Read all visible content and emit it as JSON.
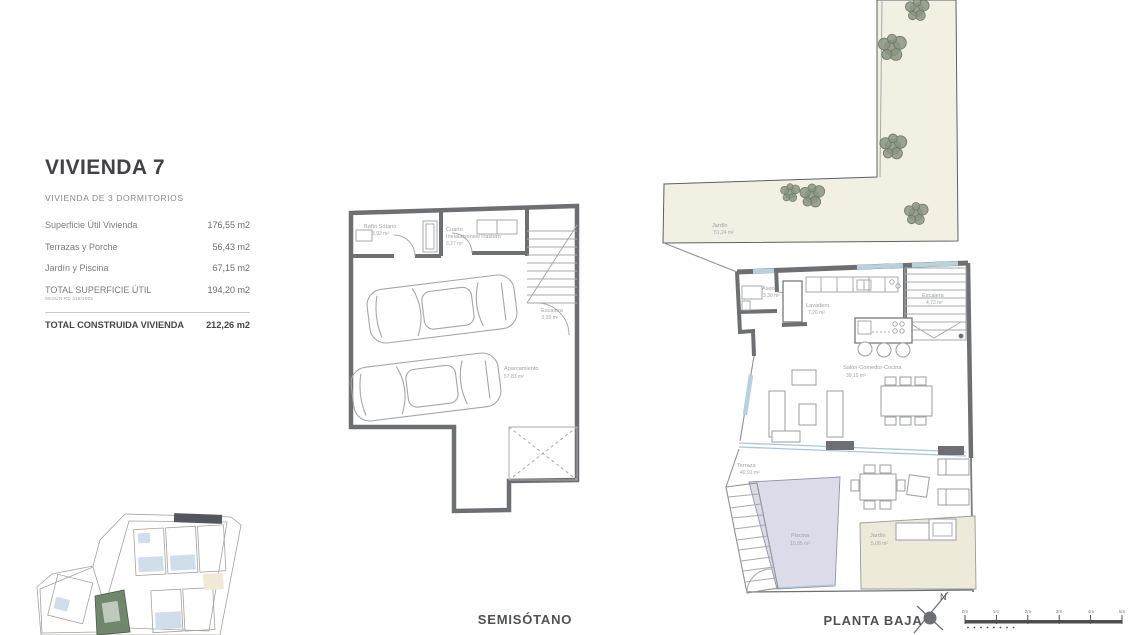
{
  "info": {
    "title": "VIVIENDA 7",
    "subtitle": "VIVIENDA DE 3 DORMITORIOS",
    "rows": [
      {
        "label": "Superficie Útil Vivienda",
        "value": "176,55 m2"
      },
      {
        "label": "Terrazas y Porche",
        "value": "56,43 m2"
      },
      {
        "label": "Jardín y Piscina",
        "value": "67,15 m2"
      },
      {
        "label": "TOTAL SUPERFICIE ÚTIL",
        "note": "SEGÚN RD 318/2005",
        "value": "194,20 m2"
      }
    ],
    "total": {
      "label": "TOTAL CONSTRUIDA VIVIENDA",
      "value": "212,26 m2"
    }
  },
  "semisotano": {
    "caption": "SEMISÓTANO",
    "rooms": {
      "bano": {
        "name": "Baño Sótano",
        "area": "3,92 m²"
      },
      "cuarto": {
        "name": "Cuarto",
        "name2": "Instalaciones/Trastero",
        "area": "6,27 m²"
      },
      "escalera": {
        "name": "Escalera",
        "area": "2,39 m²"
      },
      "aparcamiento": {
        "name": "Aparcamiento",
        "area": "57,83 m²"
      }
    }
  },
  "planta_baja": {
    "caption": "PLANTA BAJA",
    "rooms": {
      "jardin": {
        "name": "Jardín",
        "area": "51,24 m²"
      },
      "aseo": {
        "name": "Aseo",
        "area": "3,30 m²"
      },
      "lavadero": {
        "name": "Lavadero",
        "area": "7,26 m²"
      },
      "escalera": {
        "name": "Escalera",
        "area": "4,73 m²"
      },
      "salon": {
        "name": "Salón-Comedor-Cocina",
        "area": "39,15 m²"
      },
      "terraza": {
        "name": "Terraza",
        "area": "40,91 m²"
      },
      "piscina": {
        "name": "Piscina",
        "area": "10,85 m²"
      },
      "jardin_priv": {
        "name": "Jardín",
        "area": "5,08 m²"
      }
    }
  },
  "compass": {
    "label": "N"
  },
  "scale_bar": {
    "ticks": [
      "0m",
      "1m",
      "2m",
      "3m",
      "4m",
      "5m"
    ]
  },
  "colors": {
    "wall": "#6e6f72",
    "window": "#b7d1dd",
    "garden": "#f1f0e3",
    "pool": "#dcdbea",
    "garden_small": "#edead9",
    "site_olive": "#e2e5c2",
    "site_blue": "#cfdeea",
    "site_cream": "#efe9d6",
    "site_highlight": "#71876d"
  }
}
